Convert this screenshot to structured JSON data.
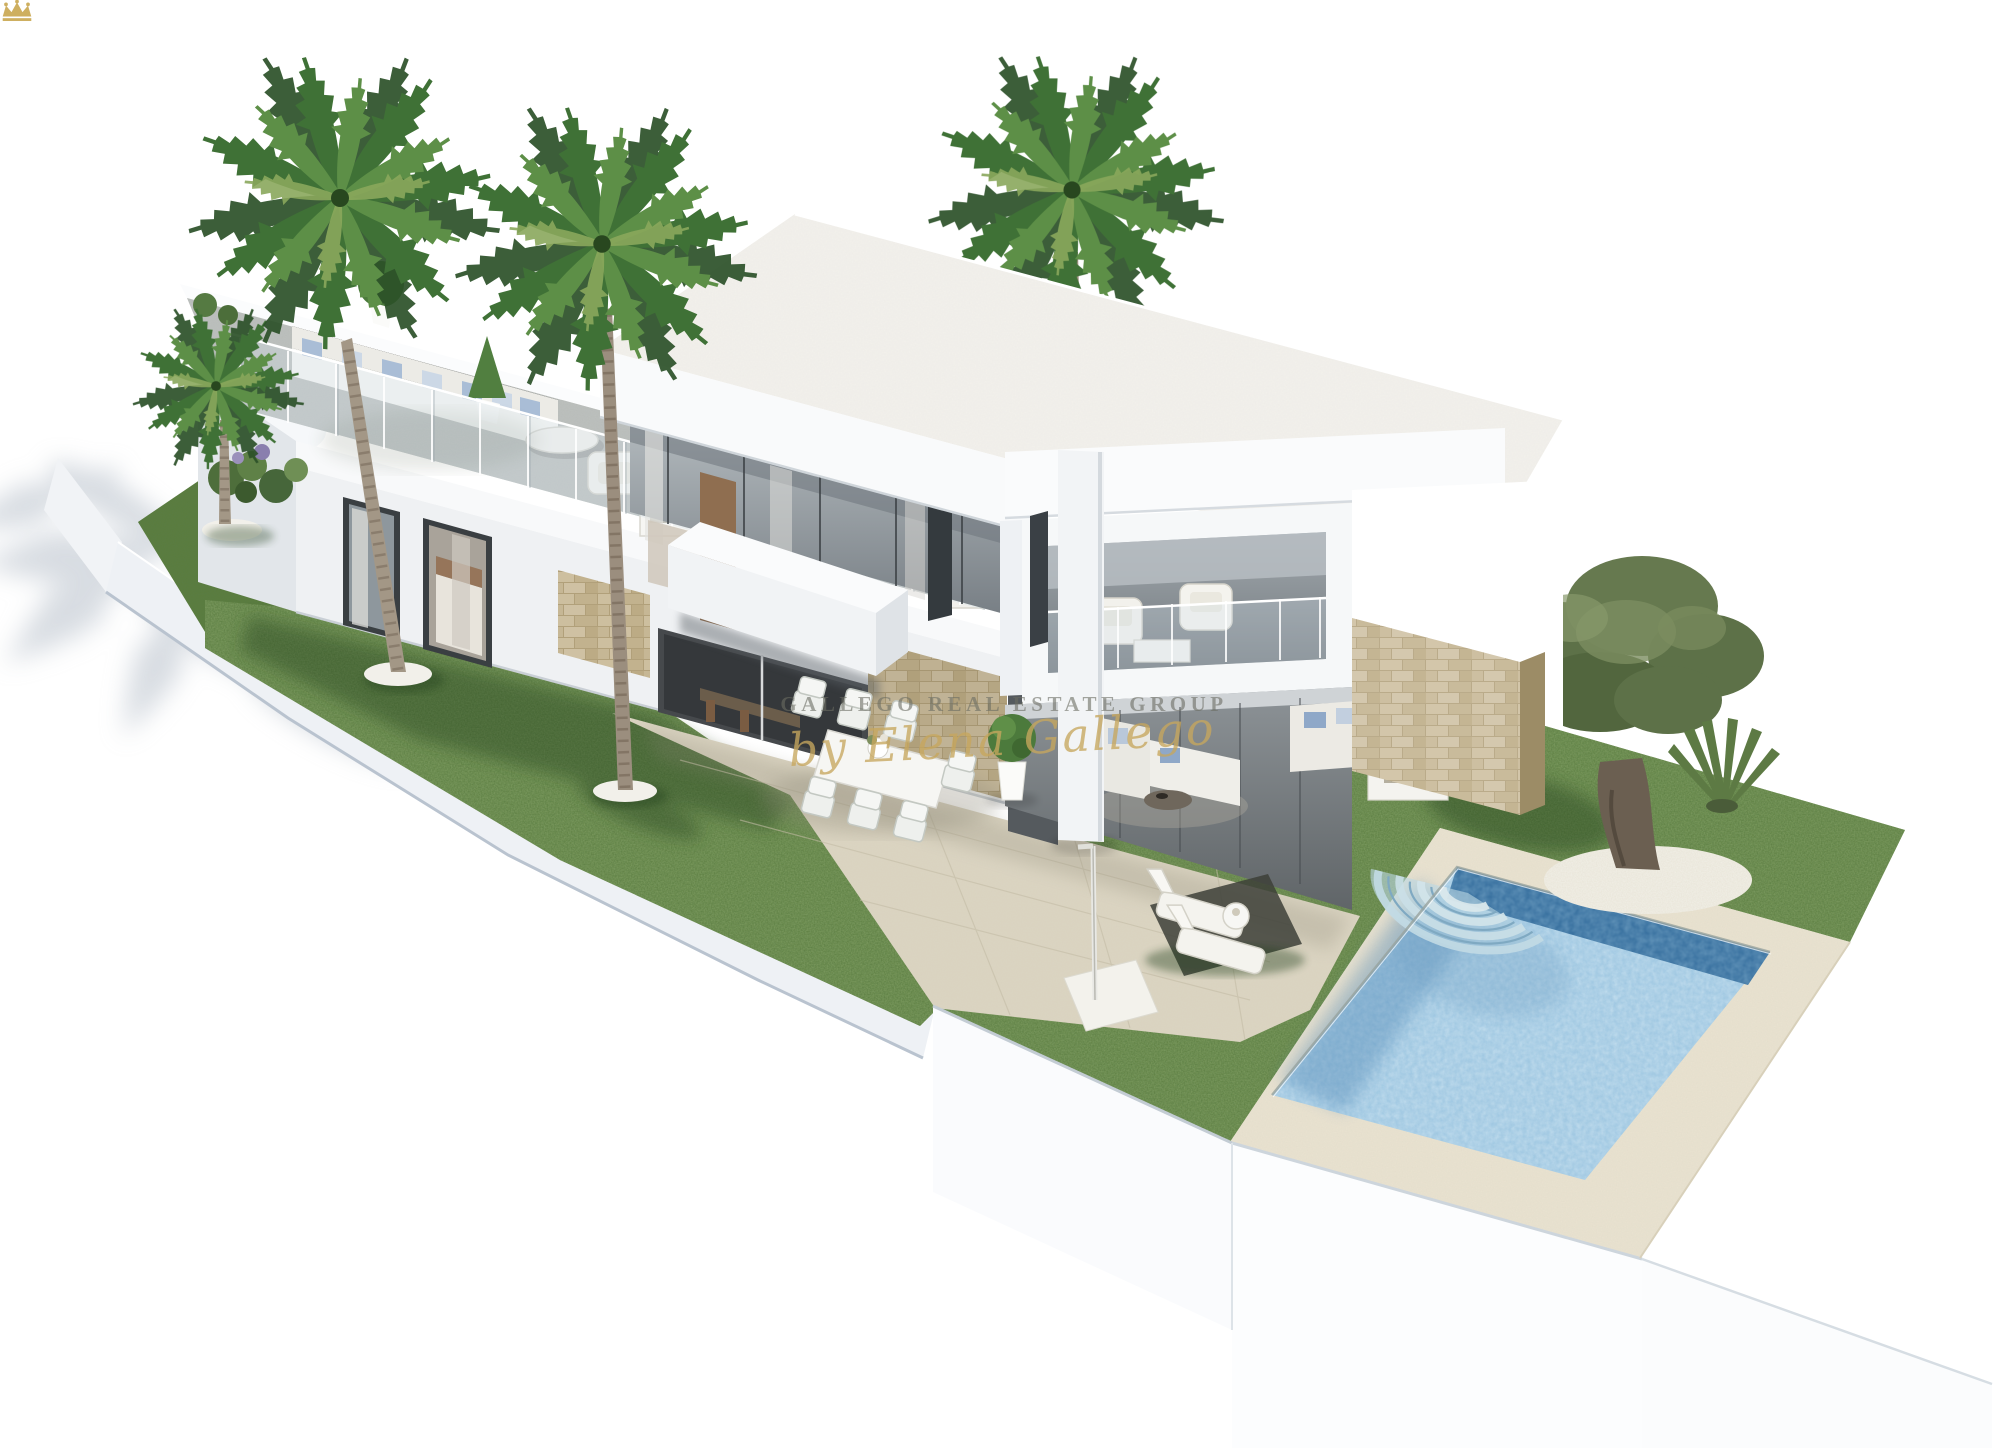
{
  "watermark": {
    "crown_icon": "crown-icon",
    "brand_text": "GALLEGO REAL ESTATE GROUP",
    "signature_text": "by Elena Gallego",
    "brand_color": "#6a6c62",
    "signature_color": "#c7a65d"
  },
  "scene": {
    "description": "Photorealistic 3D architectural rendering of a modern two-storey white villa with rooftop terrace and glass balustrades, covered patio lounge, outdoor dining set, landscaped lawns, palm trees, an olive tree, sun loungers and a private swimming pool with curved steps, viewed from an elevated corner angle on a pure white background",
    "background_color": "#ffffff"
  },
  "palette": {
    "grass_green": "#5a7c3c",
    "grass_shadow": "#2f4c22",
    "terrace_tile": "#d9d2bf",
    "rooftop_floor": "#b7bbb8",
    "pool_deck": "#eae3d1",
    "pool_water": "#9cc6e2",
    "pool_water_deep": "#336c9c",
    "stone_wall": "#c6b795",
    "house_white": "#f7f8f9",
    "house_shade": "#e3e6ea",
    "glass": "#8e979d",
    "wood_accent": "#9675550",
    "palm_frond": "#3f7136",
    "palm_trunk": "#a39786",
    "olive_foliage": "#66774d",
    "cushion_blue": "#a9bdd6",
    "furniture_white": "#f2f1ec"
  },
  "objects": [
    "modern white villa",
    "rooftop terrace with outdoor sofas and potted plants",
    "glass balustrade",
    "upper floor balcony with armchairs",
    "covered patio lounge",
    "outdoor dining table with chairs",
    "stone feature walls",
    "swimming pool with curved steps",
    "pool deck",
    "sun loungers with side table",
    "outdoor shower",
    "garden lawns",
    "olive tree on gravel circle",
    "fan palm shrub",
    "palm trees"
  ]
}
